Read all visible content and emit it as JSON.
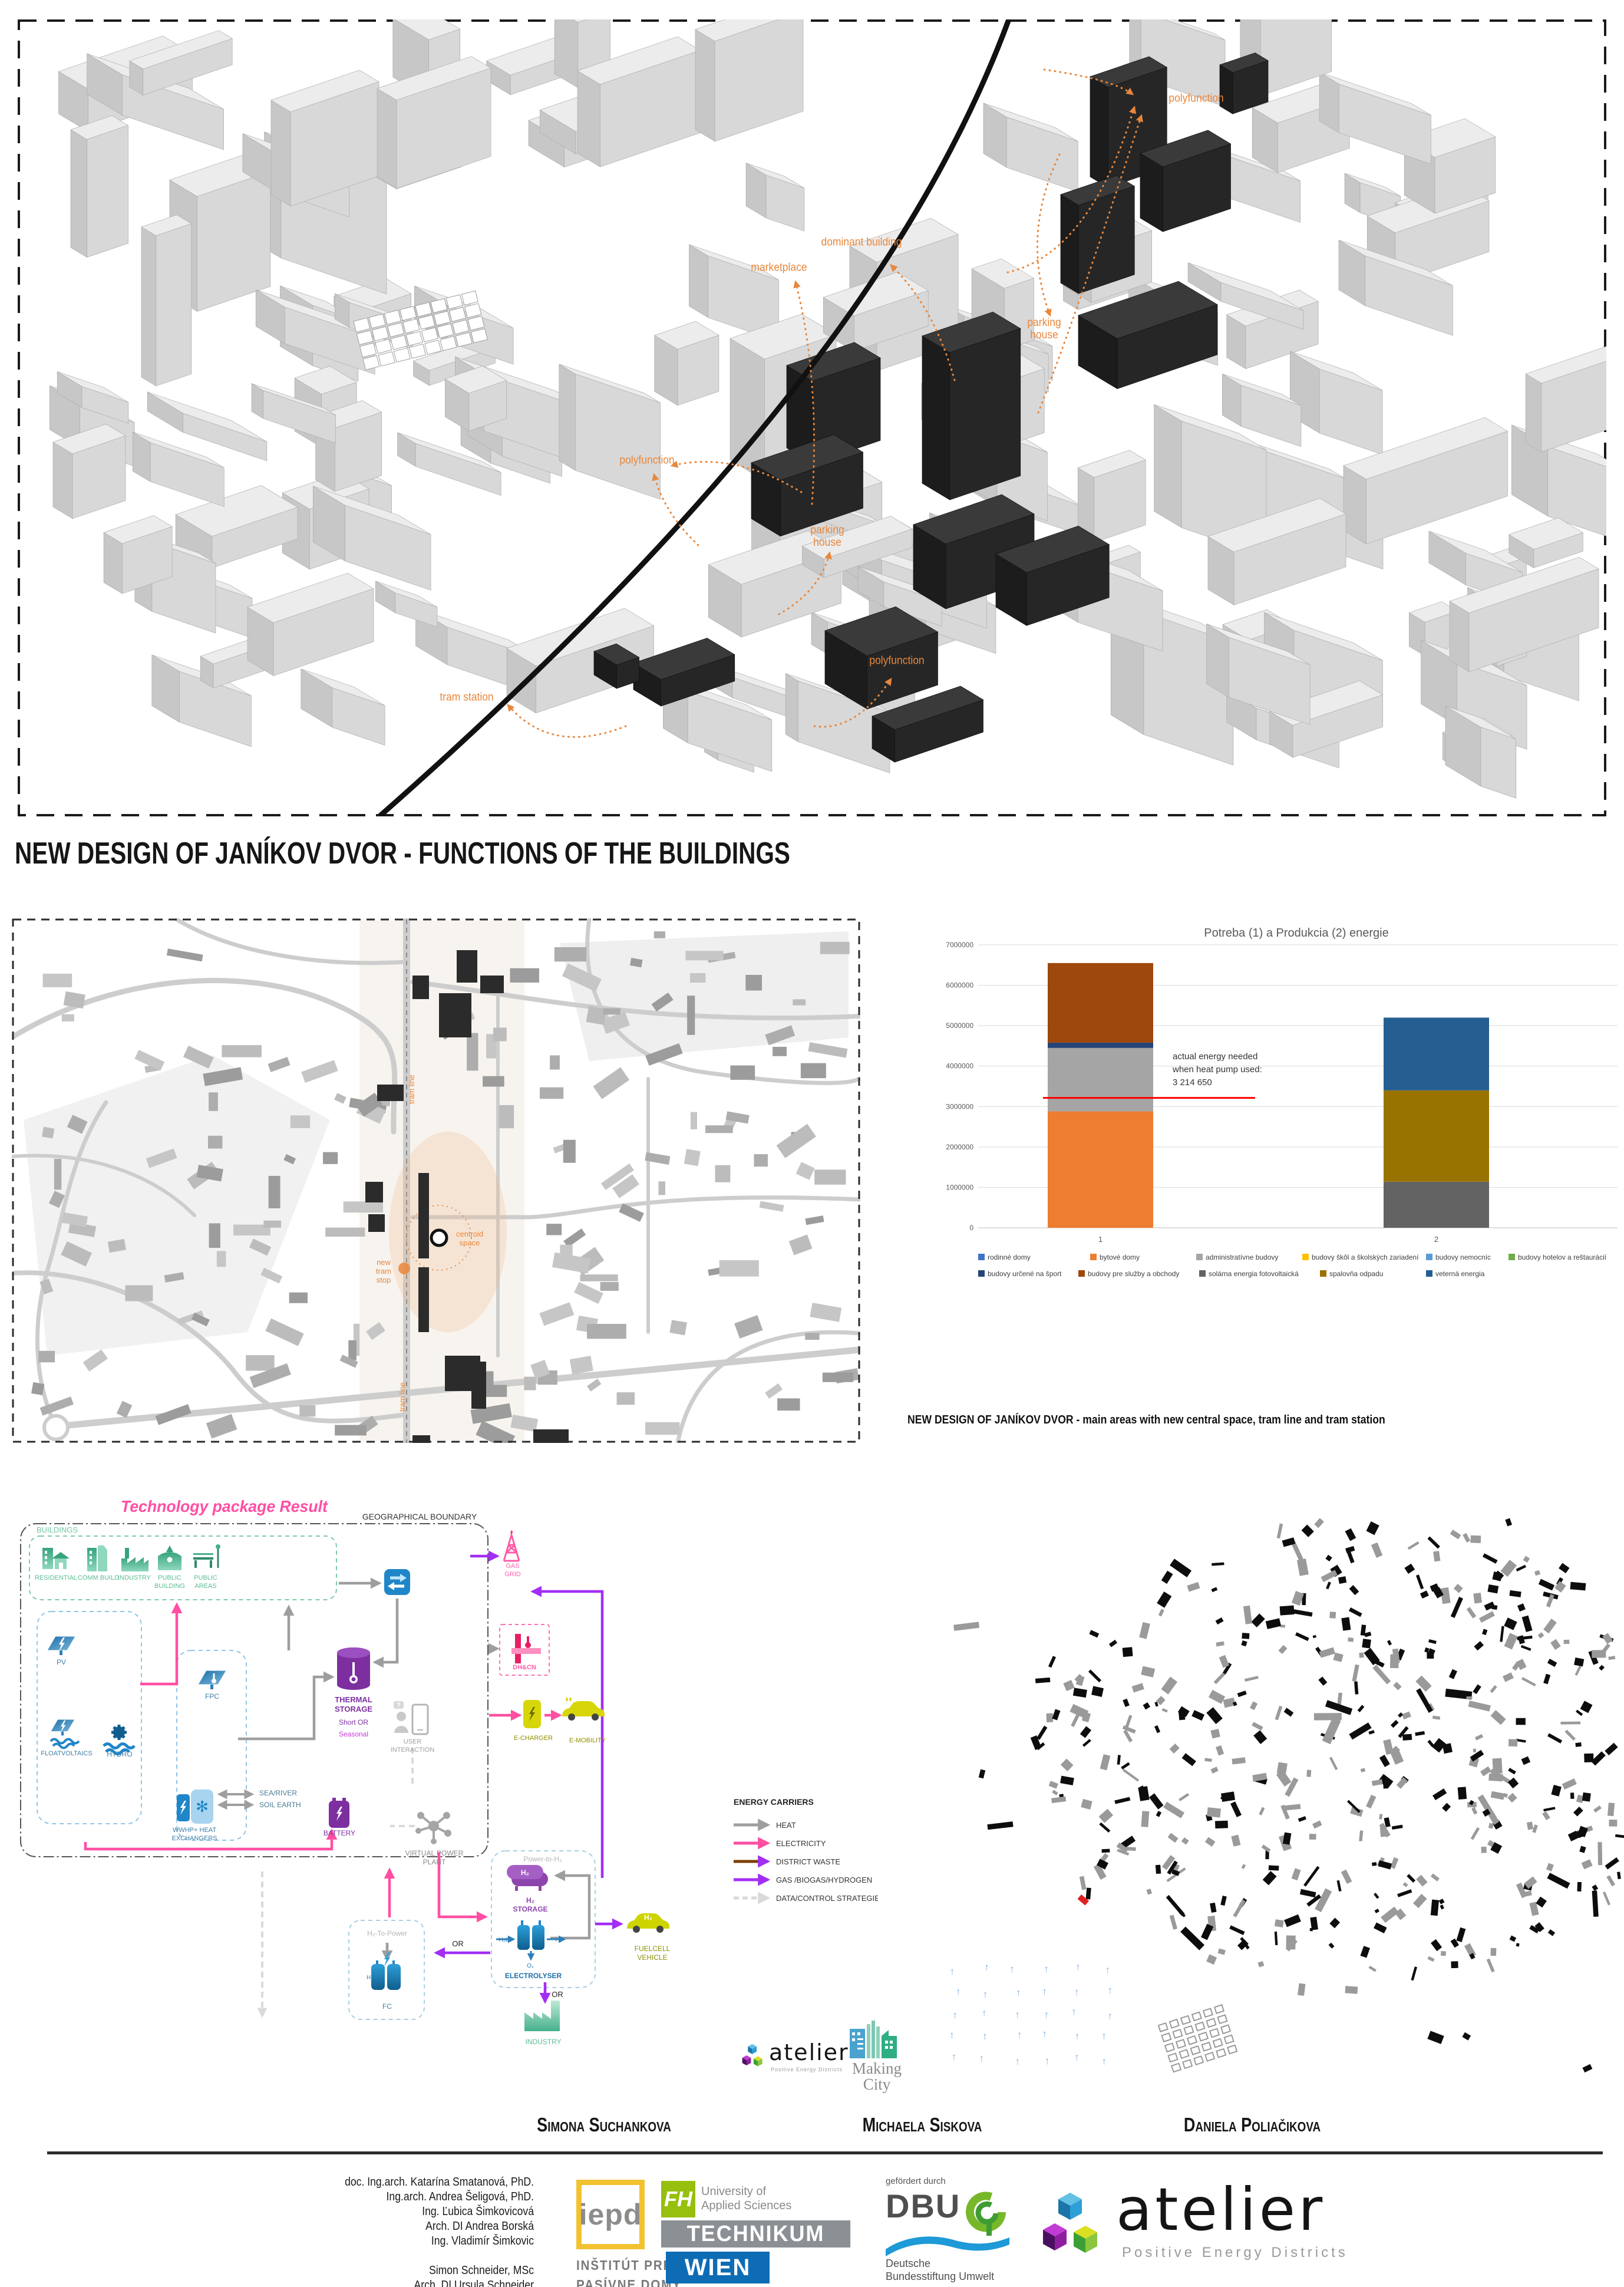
{
  "header": {
    "title": "NEW DESIGN OF JANÍKOV DVOR - FUNCTIONS OF THE BUILDINGS"
  },
  "captions": {
    "map": "NEW DESIGN OF JANÍKOV DVOR - main areas with new central space, tram line and tram station"
  },
  "model3d": {
    "annotation_color": "#E8873C",
    "annotations": [
      {
        "text": "polyfunction",
        "x": 2030,
        "y": 168
      },
      {
        "text": "dominant building",
        "x": 1462,
        "y": 412
      },
      {
        "text": "marketplace",
        "x": 1322,
        "y": 455
      },
      {
        "text": "parking\nhouse",
        "x": 1772,
        "y": 560
      },
      {
        "text": "polyfunction",
        "x": 1098,
        "y": 782
      },
      {
        "text": "parking\nhouse",
        "x": 1404,
        "y": 912
      },
      {
        "text": "tram station",
        "x": 792,
        "y": 1184
      },
      {
        "text": "polyfunction",
        "x": 1522,
        "y": 1122
      }
    ]
  },
  "map2d": {
    "labels": [
      {
        "text": "tram line",
        "x": 703,
        "y": 1848,
        "rot": -90
      },
      {
        "text": "centroid\nspace",
        "x": 797,
        "y": 2098,
        "rot": 0
      },
      {
        "text": "new\ntram\nstop",
        "x": 651,
        "y": 2146,
        "rot": 0
      },
      {
        "text": "tram line",
        "x": 687,
        "y": 2370,
        "rot": -90
      }
    ]
  },
  "chart_data": {
    "type": "bar",
    "title": "Potreba (1) a Produkcia (2) energie",
    "categories": [
      "1",
      "2"
    ],
    "ylim": [
      0,
      7000000
    ],
    "ytick_step": 1000000,
    "grid": true,
    "legend_position": "bottom",
    "series": [
      {
        "name": "rodinné domy",
        "color": "#4472C4",
        "values": [
          0,
          0
        ]
      },
      {
        "name": "bytové domy",
        "color": "#ED7D31",
        "values": [
          2880000,
          0
        ]
      },
      {
        "name": "administratívne budovy",
        "color": "#A5A5A5",
        "values": [
          1570000,
          0
        ]
      },
      {
        "name": "budovy škôl a školských zariadení",
        "color": "#FFC000",
        "values": [
          0,
          0
        ]
      },
      {
        "name": "budovy nemocníc",
        "color": "#5B9BD5",
        "values": [
          0,
          0
        ]
      },
      {
        "name": "budovy hotelov a reštaurácií",
        "color": "#70AD47",
        "values": [
          0,
          0
        ]
      },
      {
        "name": "budovy určené na šport",
        "color": "#264478",
        "values": [
          130000,
          0
        ]
      },
      {
        "name": "budovy pre služby a obchody",
        "color": "#9E480E",
        "values": [
          1970000,
          0
        ]
      },
      {
        "name": "solárna energia fotovoltaická",
        "color": "#636363",
        "values": [
          0,
          1140000
        ]
      },
      {
        "name": "spalovňa odpadu",
        "color": "#997300",
        "values": [
          0,
          2260000
        ]
      },
      {
        "name": "veterná energia",
        "color": "#255E91",
        "values": [
          0,
          1800000
        ]
      }
    ],
    "legend_rows": [
      [
        0,
        1,
        2,
        3,
        4,
        5
      ],
      [
        6,
        7,
        8,
        9,
        10
      ]
    ],
    "annotation": {
      "lines": [
        "actual energy needed",
        "when heat pump used:",
        "3 214 650"
      ],
      "value": 3214650,
      "color": "#FF0000"
    }
  },
  "tech": {
    "title": "Technology package Result",
    "boundary_label": "GEOGRAPHICAL BOUNDARY",
    "buildings_label": "BUILDINGS",
    "labels": [
      {
        "text": "RESIDENTIAL",
        "x": 95,
        "y": 2680,
        "c": "#5bbd93",
        "fs": 11
      },
      {
        "text": "COMM BUILD",
        "x": 167,
        "y": 2680,
        "c": "#5bbd93",
        "fs": 11
      },
      {
        "text": "INDUSTRY",
        "x": 228,
        "y": 2680,
        "c": "#5bbd93",
        "fs": 11
      },
      {
        "text": "PUBLIC\nBUILDING",
        "x": 288,
        "y": 2680,
        "c": "#5bbd93",
        "fs": 11
      },
      {
        "text": "PUBLIC\nAREAS",
        "x": 349,
        "y": 2680,
        "c": "#5bbd93",
        "fs": 11
      },
      {
        "text": "PV",
        "x": 104,
        "y": 2824,
        "c": "#3d7ea6",
        "fs": 12
      },
      {
        "text": "FPC",
        "x": 360,
        "y": 2882,
        "c": "#3d7ea6",
        "fs": 12
      },
      {
        "text": "FLOATVOLTAICS",
        "x": 113,
        "y": 2978,
        "c": "#3d7ea6",
        "fs": 11
      },
      {
        "text": "HYDRO",
        "x": 203,
        "y": 2980,
        "c": "#3d7ea6",
        "fs": 12
      },
      {
        "text": "WWHP+ HEAT\nEXCHANGERS",
        "x": 330,
        "y": 3108,
        "c": "#3d7ea6",
        "fs": 11
      },
      {
        "text": "SEA/RIVER",
        "x": 440,
        "y": 3046,
        "c": "#4a7a96",
        "fs": 12,
        "anchor": "start"
      },
      {
        "text": "SOIL EARTH",
        "x": 440,
        "y": 3066,
        "c": "#4a7a96",
        "fs": 12,
        "anchor": "start"
      },
      {
        "text": "THERMAL\nSTORAGE",
        "x": 600,
        "y": 2888,
        "c": "#7d2fa0",
        "fs": 13,
        "bold": true
      },
      {
        "text": "Short OR",
        "x": 600,
        "y": 2926,
        "c": "#7d2fa0",
        "fs": 12
      },
      {
        "text": "Seasonal",
        "x": 600,
        "y": 2946,
        "c": "#c23bd4",
        "fs": 12
      },
      {
        "text": "USER\nINTERACTION",
        "x": 700,
        "y": 2958,
        "c": "#9e9e9e",
        "fs": 11
      },
      {
        "text": "BATTERY",
        "x": 576,
        "y": 3114,
        "c": "#7d2fa0",
        "fs": 12
      },
      {
        "text": "VIRTUAL POWER\nPLANT",
        "x": 737,
        "y": 3148,
        "c": "#8a8a8a",
        "fs": 12
      },
      {
        "text": "GAS\nGRID",
        "x": 870,
        "y": 2660,
        "c": "#ff5ca8",
        "fs": 11
      },
      {
        "text": "DH&CN",
        "x": 890,
        "y": 2832,
        "c": "#ff5ca8",
        "fs": 11,
        "bold": true
      },
      {
        "text": "E-CHARGER",
        "x": 905,
        "y": 2952,
        "c": "#8f8f00",
        "fs": 11
      },
      {
        "text": "E-MOBILITY",
        "x": 997,
        "y": 2956,
        "c": "#8f8f00",
        "fs": 11
      },
      {
        "text": "Power-to-H₂",
        "x": 921,
        "y": 3158,
        "c": "#b5b5b5",
        "fs": 12
      },
      {
        "text": "H₂\nSTORAGE",
        "x": 900,
        "y": 3228,
        "c": "#8e44ad",
        "fs": 12,
        "bold": true
      },
      {
        "text": "H₂O",
        "x": 856,
        "y": 3294,
        "c": "#2d7fb8",
        "fs": 10
      },
      {
        "text": "H₂",
        "x": 948,
        "y": 3294,
        "c": "#2d7fb8",
        "fs": 10
      },
      {
        "text": "O₂",
        "x": 900,
        "y": 3338,
        "c": "#2d7fb8",
        "fs": 10
      },
      {
        "text": "ELECTROLYSER",
        "x": 905,
        "y": 3356,
        "c": "#1f6fa8",
        "fs": 12,
        "bold": true
      },
      {
        "text": "FUELCELL\nVEHICLE",
        "x": 1107,
        "y": 3310,
        "c": "#8f8f00",
        "fs": 12
      },
      {
        "text": "OR",
        "x": 777,
        "y": 3302,
        "c": "#222",
        "fs": 13
      },
      {
        "text": "OR",
        "x": 946,
        "y": 3388,
        "c": "#222",
        "fs": 13
      },
      {
        "text": "H₂-To-Power",
        "x": 657,
        "y": 3284,
        "c": "#b5b5b5",
        "fs": 12
      },
      {
        "text": "FC",
        "x": 657,
        "y": 3408,
        "c": "#3d7ea6",
        "fs": 12
      },
      {
        "text": "INDUSTRY",
        "x": 922,
        "y": 3468,
        "c": "#5bbd93",
        "fs": 12
      }
    ],
    "legend": {
      "title": "ENERGY CARRIERS",
      "items": [
        {
          "label": "HEAT",
          "color": "#9e9e9e",
          "dashed": false
        },
        {
          "label": "ELECTRICITY",
          "color": "#ff4fa3",
          "dashed": false
        },
        {
          "label": "DISTRICT WASTE",
          "color": "#7b3f00",
          "dashed": false
        },
        {
          "label": "GAS /BIOGAS/HYDROGEN",
          "color": "#a22ef5",
          "dashed": false
        },
        {
          "label": "DATA/CONTROL STRATEGIES",
          "color": "#d9d9d9",
          "dashed": true
        }
      ]
    }
  },
  "team": [
    "Simona Suchankova",
    "Michaela Siskova",
    "Daniela Poliačikova"
  ],
  "credits": [
    "doc. Ing.arch. Katarína Smatanová, PhD.",
    "Ing.arch. Andrea Šeligová, PhD.",
    "Ing. Ľubica Šimkovicová",
    "Arch. DI Andrea Borská",
    "Ing. Vladimír Šimkovic",
    "",
    "Simon Schneider, MSc",
    "Arch. DI Ursula Schneider"
  ],
  "logos": {
    "iepd": {
      "acronym": "iepd",
      "line1": "INŠTITÚT PRE",
      "line2": "PASÍVNE DOMY"
    },
    "fh": {
      "abbr": "FH",
      "uni1": "University of",
      "uni2": "Applied Sciences",
      "technikum": "TECHNIKUM",
      "wien": "WIEN"
    },
    "dbu": {
      "funded": "gefördert durch",
      "abbr": "DBU",
      "line1": "Deutsche",
      "line2": "Bundesstiftung Umwelt"
    },
    "atelier": {
      "name": "atelier",
      "sub": "Positive Energy Districts"
    },
    "making_city": {
      "line1": "Making",
      "line2": "City"
    }
  }
}
